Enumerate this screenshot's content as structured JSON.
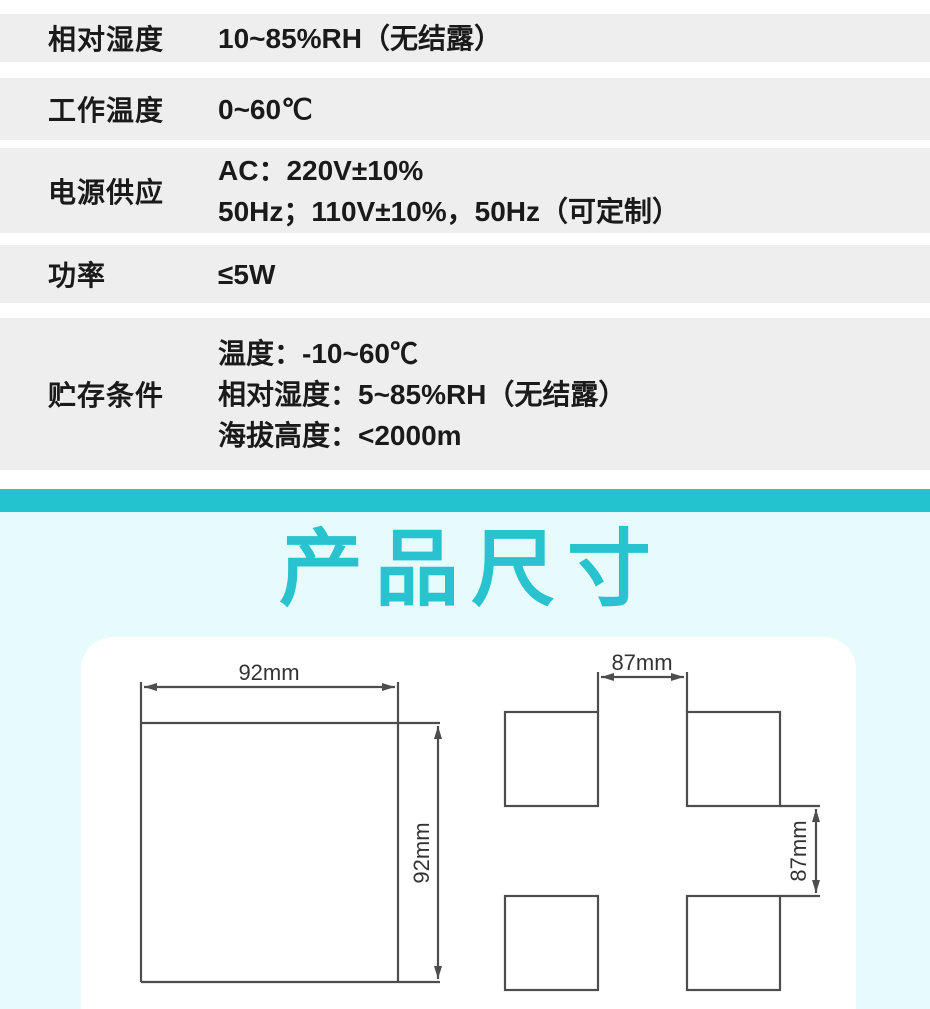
{
  "spec_table": {
    "rows": [
      {
        "label": "相对湿度",
        "lines": [
          "10~85%RH（无结露）"
        ]
      },
      {
        "label": "工作温度",
        "lines": [
          "0~60℃"
        ]
      },
      {
        "label": "电源供应",
        "lines": [
          "AC：220V±10%",
          "50Hz；110V±10%，50Hz（可定制）"
        ]
      },
      {
        "label": "功率",
        "lines": [
          "≤5W"
        ]
      },
      {
        "label": "贮存条件",
        "lines": [
          "温度：-10~60℃",
          "相对湿度：5~85%RH（无结露）",
          "海拔高度：<2000m"
        ]
      }
    ]
  },
  "section": {
    "title": "产品尺寸"
  },
  "diagram": {
    "front_view": {
      "width_label": "92mm",
      "height_label": "92mm"
    },
    "cutout_view": {
      "width_label": "87mm",
      "height_label": "87mm"
    }
  },
  "colors": {
    "accent_teal": "#23c3d0",
    "title_teal": "#29c3cf",
    "section_bg": "#e7fbfd",
    "row_bg": "#eeeeee",
    "text": "#1a1a1a",
    "drawing_line": "#4d4d4d"
  }
}
